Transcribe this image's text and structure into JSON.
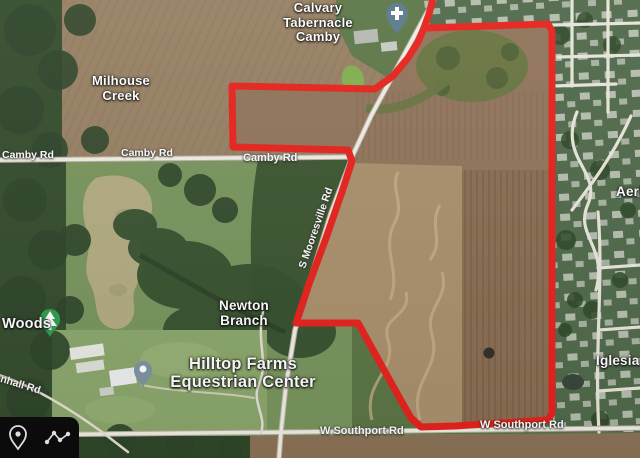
{
  "app": {
    "view": "satellite-map-screenshot"
  },
  "colors": {
    "boundary": "#e9211b",
    "toolbar_bg": "#0b0b0b",
    "church_pin": "#5b7a8c",
    "park_pin": "#2b9e4f",
    "place_pin": "#7d93a1",
    "label_text": "#ffffff"
  },
  "labels": {
    "calvary": "Calvary Tabernacle Camby",
    "milhouse": "Milhouse Creek",
    "newton": "Newton Branch",
    "hilltop": "Hilltop Farms Equestrian Center",
    "woods": "Woods",
    "aeri_partial": "Aeri",
    "iglesia_partial": "Iglesia"
  },
  "roads": {
    "camby": "Camby Rd",
    "mooresville": "S Mooresville Rd",
    "southport": "W Southport Rd",
    "mendenhall_partial": "enhall Rd"
  },
  "markers": {
    "church": "cross-icon",
    "park": "tree-icon",
    "equestrian": "place-icon"
  },
  "toolbar": {
    "icons": [
      "location-pin",
      "route"
    ]
  }
}
